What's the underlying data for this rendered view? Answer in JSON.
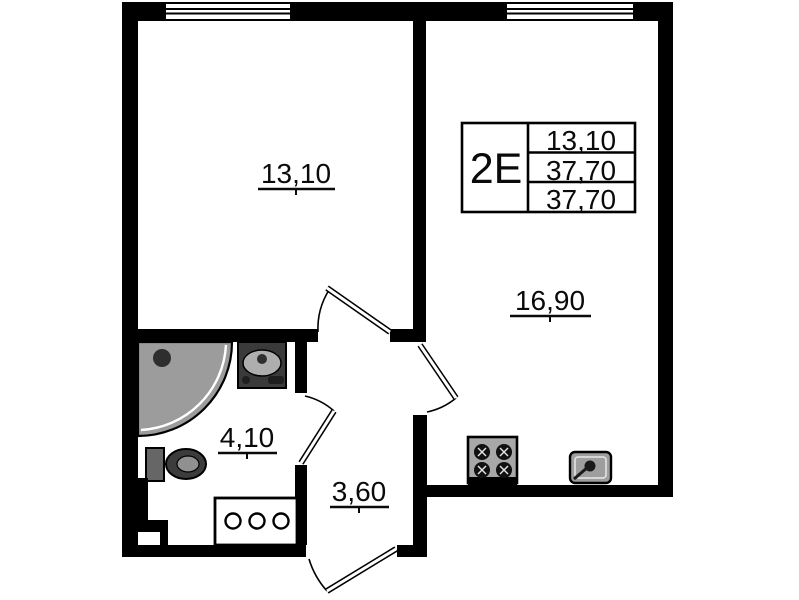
{
  "floorplan": {
    "info_box": {
      "type_code": "2Е",
      "values": [
        "13,10",
        "37,70",
        "37,70"
      ]
    },
    "rooms": {
      "bedroom": {
        "area": "13,10"
      },
      "kitchen_living": {
        "area": "16,90"
      },
      "bathroom": {
        "area": "4,10"
      },
      "hallway": {
        "area": "3,60"
      }
    },
    "icons": {
      "window": "triple-stripe-window",
      "door": "arc-swing-door",
      "shower": "corner-shower-tray",
      "washbasin": "bathroom-washbasin",
      "toilet": "toilet",
      "cabinet": "cabinet-three-knobs",
      "stove": "four-burner-stove",
      "kitchen_sink": "kitchen-sink",
      "vent_duct": "ventilation-duct"
    },
    "colors": {
      "wall": "#000000",
      "background": "#ffffff",
      "shower_tray": "#9c9c9c",
      "fixture_dark": "#3c3c3c",
      "fixture_gray": "#a8a8a8"
    }
  }
}
